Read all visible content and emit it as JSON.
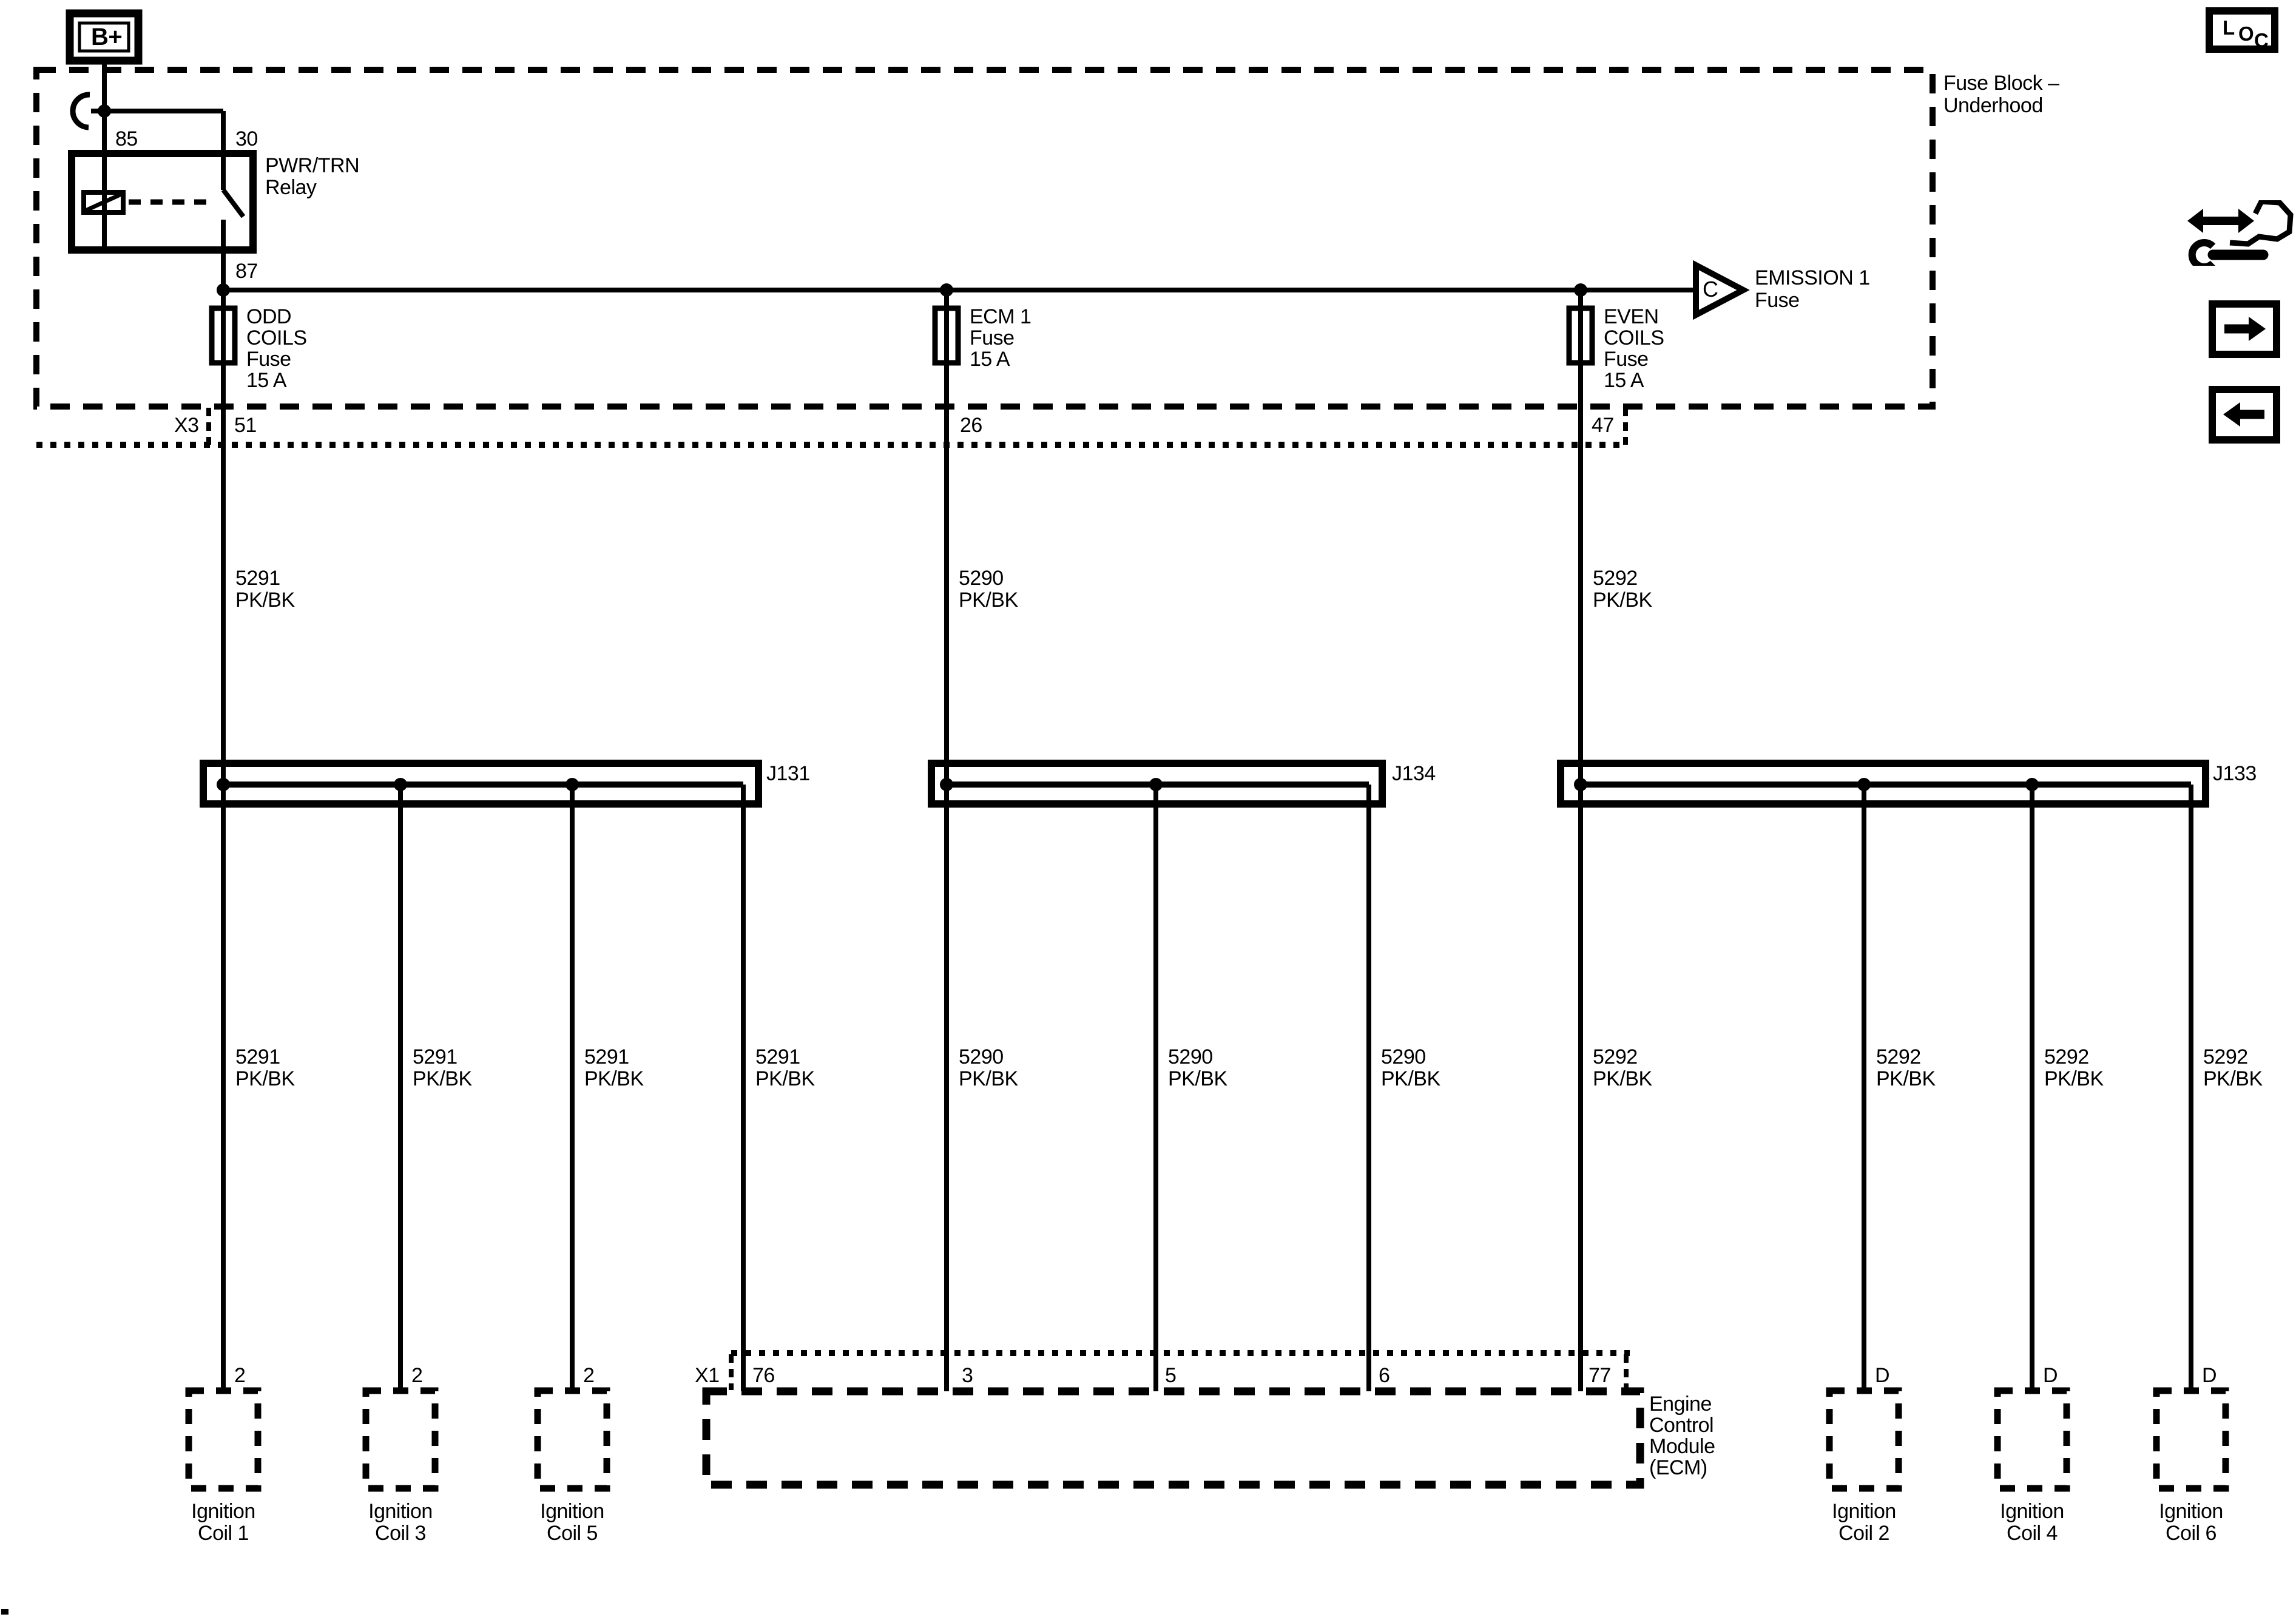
{
  "colors": {
    "ink": "#000000",
    "paper": "#ffffff"
  },
  "battery": {
    "label": "B+"
  },
  "fuse_block": {
    "name_line1": "Fuse Block –",
    "name_line2": "Underhood"
  },
  "relay": {
    "pin_85": "85",
    "pin_30": "30",
    "pin_87": "87",
    "name_line1": "PWR/TRN",
    "name_line2": "Relay"
  },
  "fuses": {
    "odd": {
      "l1": "ODD",
      "l2": "COILS",
      "l3": "Fuse",
      "l4": "15 A",
      "pin": "51"
    },
    "ecm1": {
      "l1": "ECM 1",
      "l2": "Fuse",
      "l3": "15 A",
      "pin": "26"
    },
    "even": {
      "l1": "EVEN",
      "l2": "COILS",
      "l3": "Fuse",
      "l4": "15 A",
      "pin": "47"
    }
  },
  "emission_ref": {
    "tag": "C",
    "l1": "EMISSION 1",
    "l2": "Fuse"
  },
  "connector_x3": {
    "id": "X3"
  },
  "connector_x1": {
    "id": "X1",
    "pins": [
      "76",
      "3",
      "5",
      "6",
      "77"
    ]
  },
  "junction_blocks": {
    "j131": "J131",
    "j134": "J134",
    "j133": "J133"
  },
  "feed_wires": [
    {
      "circuit": "5291",
      "color": "PK/BK"
    },
    {
      "circuit": "5290",
      "color": "PK/BK"
    },
    {
      "circuit": "5292",
      "color": "PK/BK"
    }
  ],
  "branch_wires": [
    {
      "circuit": "5291",
      "color": "PK/BK"
    },
    {
      "circuit": "5291",
      "color": "PK/BK"
    },
    {
      "circuit": "5291",
      "color": "PK/BK"
    },
    {
      "circuit": "5291",
      "color": "PK/BK"
    },
    {
      "circuit": "5290",
      "color": "PK/BK"
    },
    {
      "circuit": "5290",
      "color": "PK/BK"
    },
    {
      "circuit": "5290",
      "color": "PK/BK"
    },
    {
      "circuit": "5292",
      "color": "PK/BK"
    },
    {
      "circuit": "5292",
      "color": "PK/BK"
    },
    {
      "circuit": "5292",
      "color": "PK/BK"
    },
    {
      "circuit": "5292",
      "color": "PK/BK"
    }
  ],
  "ecm": {
    "name_l1": "Engine",
    "name_l2": "Control",
    "name_l3": "Module",
    "name_l4": "(ECM)"
  },
  "coils": [
    {
      "pin": "2",
      "l1": "Ignition",
      "l2": "Coil 1"
    },
    {
      "pin": "2",
      "l1": "Ignition",
      "l2": "Coil 3"
    },
    {
      "pin": "2",
      "l1": "Ignition",
      "l2": "Coil 5"
    },
    {
      "pin": "D",
      "l1": "Ignition",
      "l2": "Coil 2"
    },
    {
      "pin": "D",
      "l1": "Ignition",
      "l2": "Coil 4"
    },
    {
      "pin": "D",
      "l1": "Ignition",
      "l2": "Coil 6"
    }
  ],
  "nav": {
    "loc_l": "L",
    "loc_o": "O",
    "loc_c": "C"
  }
}
